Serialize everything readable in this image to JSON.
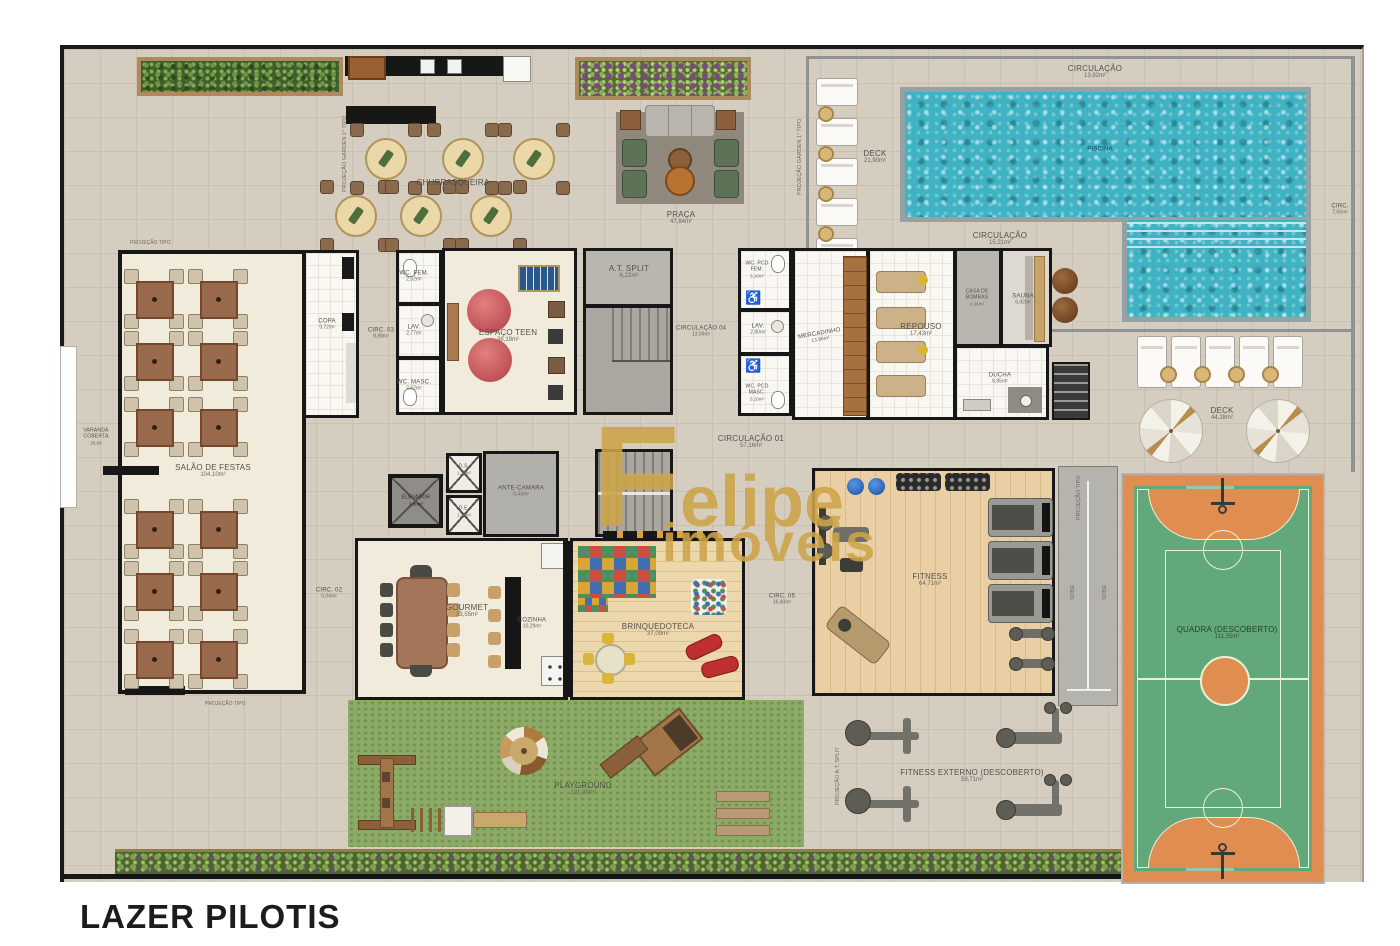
{
  "title": "LAZER PILOTIS",
  "watermark": {
    "line1": "Felipe",
    "line2": "imóveis"
  },
  "colors": {
    "plan_background": "#d5cdbf",
    "wall": "#171717",
    "water": "#3fb2c3",
    "grass": "#8cab67",
    "court_orange": "#e08d52",
    "court_green": "#63a87b",
    "watermark_gold": "#cda449",
    "room_cream": "#f1ebdc"
  },
  "labels": {
    "circulacao_piscina": {
      "name": "CIRCULAÇÃO",
      "area": "13,92m²"
    },
    "deck_esquerdo": {
      "name": "DECK",
      "area": "21,90m²"
    },
    "piscina": {
      "name": "PISCINA",
      "area": ""
    },
    "circulacao_piscina2": {
      "name": "CIRCULAÇÃO",
      "area": "15,21m²"
    },
    "circ_direita": {
      "name": "CIRC.",
      "area": "7,65m²"
    },
    "deck_direito": {
      "name": "DECK",
      "area": "44,28m²"
    },
    "churrasqueira": {
      "name": "CHURRASQUEIRA",
      "area": "52,84m²"
    },
    "praca": {
      "name": "PRAÇA",
      "area": "47,84m²"
    },
    "varanda": {
      "name": "VARANDA COBERTA",
      "area": "25,08"
    },
    "salao": {
      "name": "SALÃO DE FESTAS",
      "area": "104,10m²"
    },
    "copa": {
      "name": "COPA",
      "area": "9,72m²"
    },
    "circ03": {
      "name": "CIRC. 03",
      "area": "8,88m²"
    },
    "lav1": {
      "name": "LAV.",
      "area": "2,77m²"
    },
    "wc_fem": {
      "name": "WC. FEM.",
      "area": "2,52m²"
    },
    "wc_masc": {
      "name": "WC. MASC.",
      "area": "2,52m²"
    },
    "espaco_teen": {
      "name": "ESPAÇO TEEN",
      "area": "36,19m²"
    },
    "at_split": {
      "name": "A.T. SPLIT",
      "area": "6,22m²"
    },
    "circulacao04": {
      "name": "CIRCULAÇÃO 04",
      "area": "13,09m²"
    },
    "wc_pcd_fem": {
      "name": "WC. PCD FEM.",
      "area": "3,16m²"
    },
    "lav2": {
      "name": "LAV.",
      "area": "2,80m²"
    },
    "wc_pcd_masc": {
      "name": "WC. PCD MASC.",
      "area": "3,16m²"
    },
    "mercadinho": {
      "name": "MERCADINHO",
      "area": "13,96m²"
    },
    "repouso": {
      "name": "REPOUSO",
      "area": "17,43m²"
    },
    "casa_bombas": {
      "name": "CASA DE BOMBAS",
      "area": "4,26m²"
    },
    "sauna": {
      "name": "SAUNA",
      "area": "6,92m²"
    },
    "ducha": {
      "name": "DUCHA",
      "area": "6,85m²"
    },
    "circulacao01": {
      "name": "CIRCULAÇÃO 01",
      "area": "57,16m²"
    },
    "elevador": {
      "name": "ELEVADOR",
      "area": "3,80m²"
    },
    "ds": {
      "name": "D.S.",
      "area": "1,38m²"
    },
    "de": {
      "name": "D.E.",
      "area": "1,38m²"
    },
    "antecamara": {
      "name": "ANTE-CAMARA",
      "area": "5,43m²"
    },
    "circ02": {
      "name": "CIRC. 02",
      "area": "6,04m²"
    },
    "gourmet": {
      "name": "GOURMET",
      "area": "33,55m²"
    },
    "cozinha": {
      "name": "COZINHA",
      "area": "10,29m²"
    },
    "brinquedoteca": {
      "name": "BRINQUEDOTECA",
      "area": "37,09m²"
    },
    "circ05": {
      "name": "CIRC. 05",
      "area": "16,40m²"
    },
    "fitness": {
      "name": "FITNESS",
      "area": "64,71m²"
    },
    "playground": {
      "name": "PLAYGROUND",
      "area": "101,49m²"
    },
    "fitness_externo": {
      "name": "FITNESS EXTERNO (DESCOBERTO)",
      "area": "59,71m²"
    },
    "quadra": {
      "name": "QUADRA (DESCOBERTO)",
      "area": "111,35m²"
    },
    "sobe1": "SOBE",
    "sobe2": "SOBE",
    "proj_tipo": "PROJEÇÃO TIPO",
    "proj_garden": "PROJEÇÃO GARDEN 1° TIPO",
    "proj_at_split": "PROJEÇÃO A.T. SPLIT"
  }
}
